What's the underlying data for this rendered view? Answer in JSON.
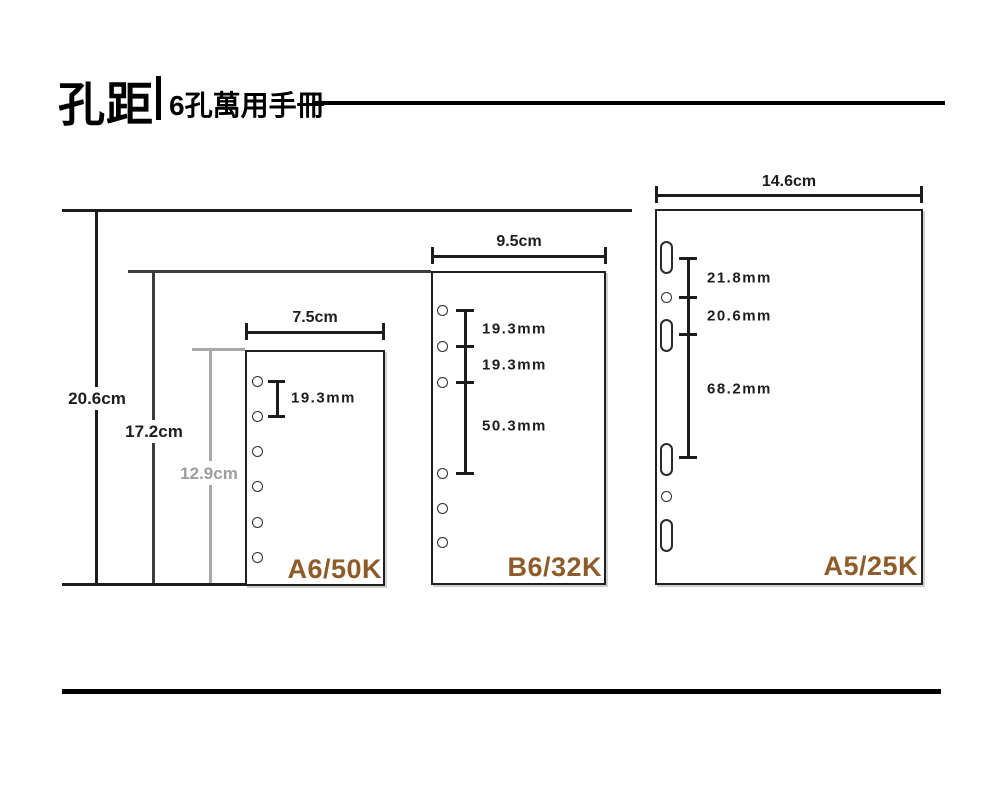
{
  "title": {
    "main": "孔距",
    "subtitle": "6孔萬用手冊"
  },
  "panels": [
    {
      "name": "A6/50K",
      "width": "7.5cm",
      "height": "12.9cm",
      "hole_count": 6,
      "gaps": [
        "19.3mm"
      ]
    },
    {
      "name": "B6/32K",
      "width": "9.5cm",
      "height": "17.2cm",
      "hole_count": 6,
      "gaps": [
        "19.3mm",
        "19.3mm",
        "50.3mm"
      ]
    },
    {
      "name": "A5/25K",
      "width": "14.6cm",
      "height": "20.6cm",
      "hole_count": 6,
      "gaps": [
        "21.8mm",
        "20.6mm",
        "68.2mm"
      ]
    }
  ],
  "colors": {
    "panel_label_brown": "#8d5c2a",
    "measure_gray": "#9d9d9d",
    "line_black": "#1d1d1d"
  }
}
